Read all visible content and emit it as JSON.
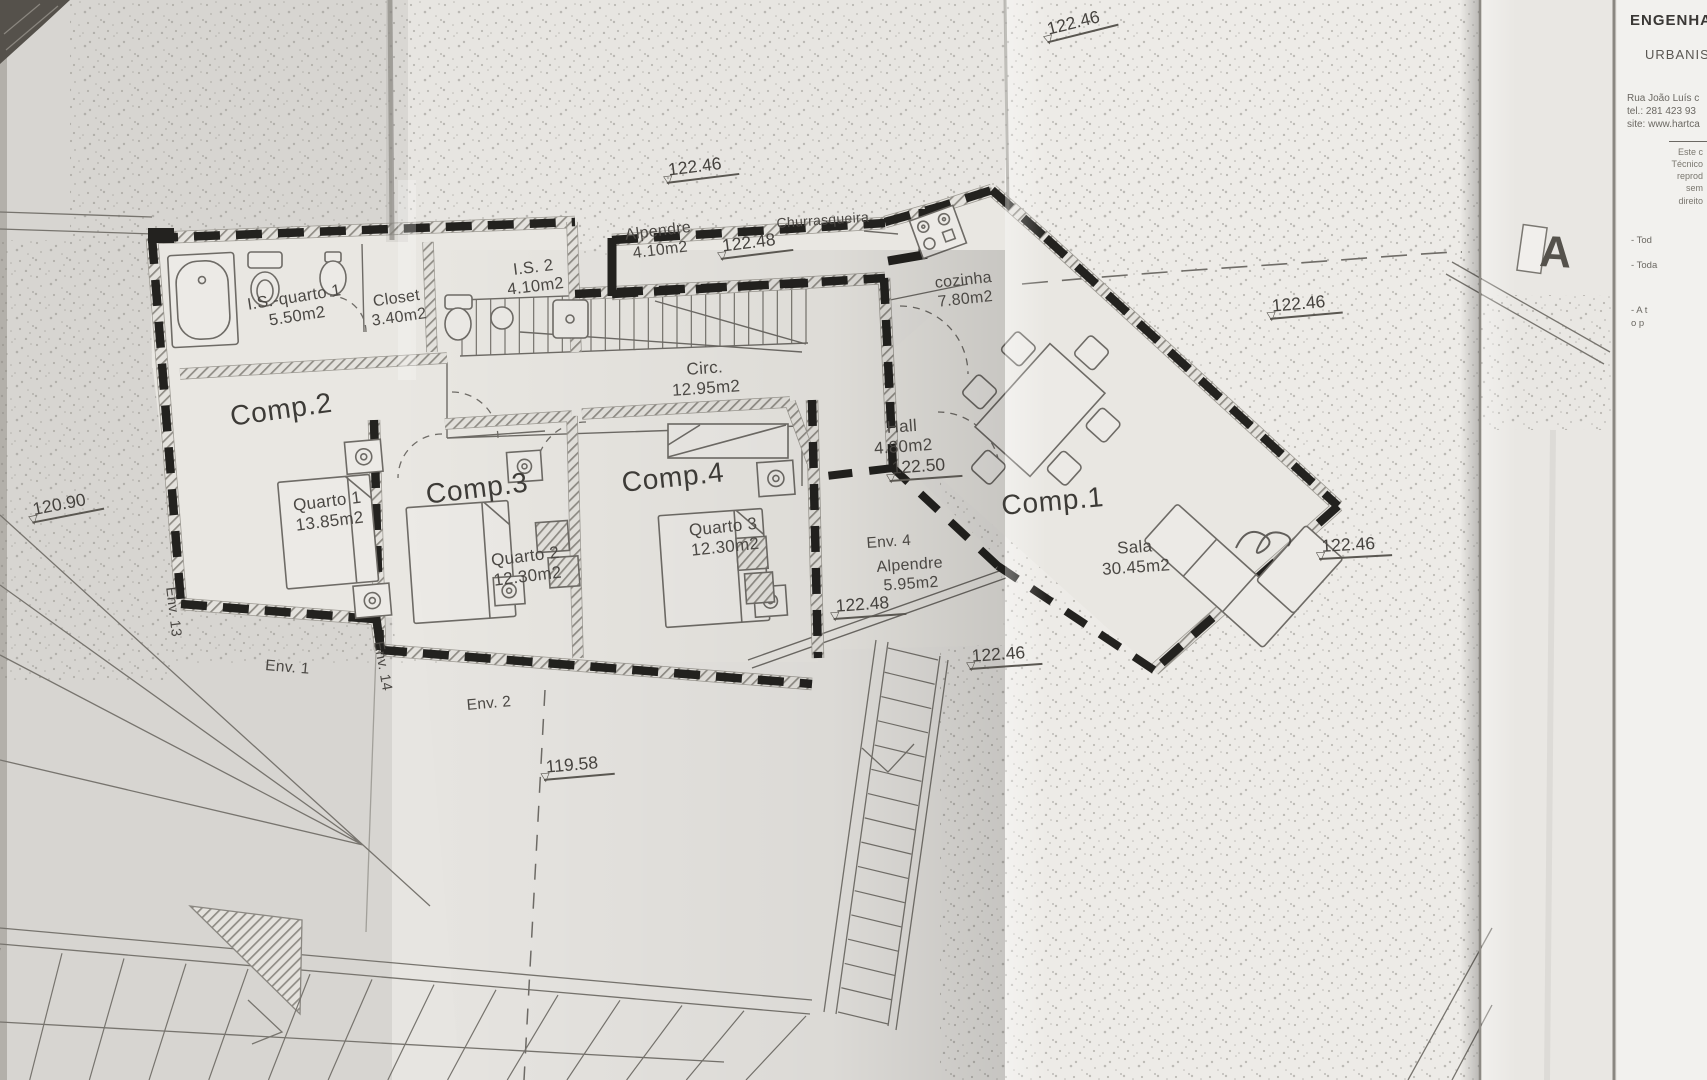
{
  "colors": {
    "paper": "#e6e4e0",
    "ink": "#4b4844",
    "wall": "#23221f"
  },
  "plan": {
    "labels": [
      {
        "text": "Comp.2",
        "x": 228,
        "y": 400,
        "size": 28,
        "rot": -8,
        "cls": "big"
      },
      {
        "text": "Quarto 1\n13.85m2",
        "x": 292,
        "y": 496,
        "size": 17,
        "rot": -7,
        "cls": ""
      },
      {
        "text": "Comp.3",
        "x": 424,
        "y": 478,
        "size": 28,
        "rot": -7,
        "cls": "big"
      },
      {
        "text": "Quarto 2\n12.30m2",
        "x": 490,
        "y": 551,
        "size": 17,
        "rot": -7,
        "cls": ""
      },
      {
        "text": "Comp.4",
        "x": 620,
        "y": 466,
        "size": 28,
        "rot": -6,
        "cls": "big"
      },
      {
        "text": "Quarto 3\n12.30m2",
        "x": 688,
        "y": 521,
        "size": 17,
        "rot": -6,
        "cls": ""
      },
      {
        "text": "Comp.1",
        "x": 1000,
        "y": 489,
        "size": 28,
        "rot": -5,
        "cls": "big"
      },
      {
        "text": "Sala\n30.45m2",
        "x": 1100,
        "y": 540,
        "size": 17,
        "rot": -4,
        "cls": ""
      },
      {
        "text": "I.S.-quarto 1\n5.50m2",
        "x": 246,
        "y": 296,
        "size": 16.5,
        "rot": -9,
        "cls": ""
      },
      {
        "text": "Closet\n3.40m2",
        "x": 368,
        "y": 294,
        "size": 16,
        "rot": -8,
        "cls": ""
      },
      {
        "text": "I.S. 2\n4.10m2",
        "x": 504,
        "y": 262,
        "size": 16.5,
        "rot": -7,
        "cls": ""
      },
      {
        "text": "Alpendre\n4.10m2",
        "x": 624,
        "y": 227,
        "size": 16,
        "rot": -7,
        "cls": ""
      },
      {
        "text": "Churrasqueira",
        "x": 776,
        "y": 215,
        "size": 14,
        "rot": -4,
        "cls": ""
      },
      {
        "text": "cozinha\n7.80m2",
        "x": 934,
        "y": 275,
        "size": 16,
        "rot": -6,
        "cls": ""
      },
      {
        "text": "Circ.\n12.95m2",
        "x": 670,
        "y": 361,
        "size": 17,
        "rot": -4,
        "cls": ""
      },
      {
        "text": "Hall\n4.80m2",
        "x": 872,
        "y": 419,
        "size": 17,
        "rot": -4,
        "cls": ""
      },
      {
        "text": "Env. 4",
        "x": 866,
        "y": 535,
        "size": 15.5,
        "rot": -4,
        "cls": ""
      },
      {
        "text": "Alpendre\n5.95m2",
        "x": 876,
        "y": 559,
        "size": 16,
        "rot": -4,
        "cls": ""
      },
      {
        "text": "Env. 1",
        "x": 266,
        "y": 657,
        "size": 15.5,
        "rot": 5,
        "cls": ""
      },
      {
        "text": "Env. 2",
        "x": 466,
        "y": 697,
        "size": 15.5,
        "rot": -5,
        "cls": ""
      },
      {
        "text": "Env. 13",
        "x": 178,
        "y": 586,
        "size": 14.5,
        "rot": 83,
        "cls": ""
      },
      {
        "text": "Env. 14",
        "x": 386,
        "y": 640,
        "size": 14.5,
        "rot": 80,
        "cls": ""
      },
      {
        "text": "A",
        "x": 1541,
        "y": 226,
        "size": 44,
        "rot": 3,
        "cls": "section"
      }
    ],
    "elevation_markers": [
      {
        "label": "122.46",
        "x": 1042,
        "y": 20,
        "rot": -14
      },
      {
        "label": "122.46",
        "x": 664,
        "y": 160,
        "rot": -7
      },
      {
        "label": "122.48",
        "x": 718,
        "y": 236,
        "rot": -7
      },
      {
        "label": "122.50",
        "x": 888,
        "y": 458,
        "rot": -4
      },
      {
        "label": "122.48",
        "x": 832,
        "y": 596,
        "rot": -4
      },
      {
        "label": "122.46",
        "x": 968,
        "y": 646,
        "rot": -4
      },
      {
        "label": "122.46",
        "x": 1268,
        "y": 296,
        "rot": -5
      },
      {
        "label": "122.46",
        "x": 1318,
        "y": 536,
        "rot": -3
      },
      {
        "label": "120.90",
        "x": 28,
        "y": 500,
        "rot": -11
      },
      {
        "label": "119.58",
        "x": 542,
        "y": 757,
        "rot": -5
      }
    ]
  },
  "title_block": {
    "line1": "ENGENHA",
    "line2": "URBANIS",
    "address": [
      "Rua João Luís c",
      "tel.: 281 423 93",
      "site: www.hartca"
    ],
    "notice": [
      "Este c",
      "Técnico",
      "reprod",
      "sem",
      "direito"
    ],
    "bullets": [
      "- Tod",
      "- Toda",
      "- A t",
      "o p"
    ]
  }
}
